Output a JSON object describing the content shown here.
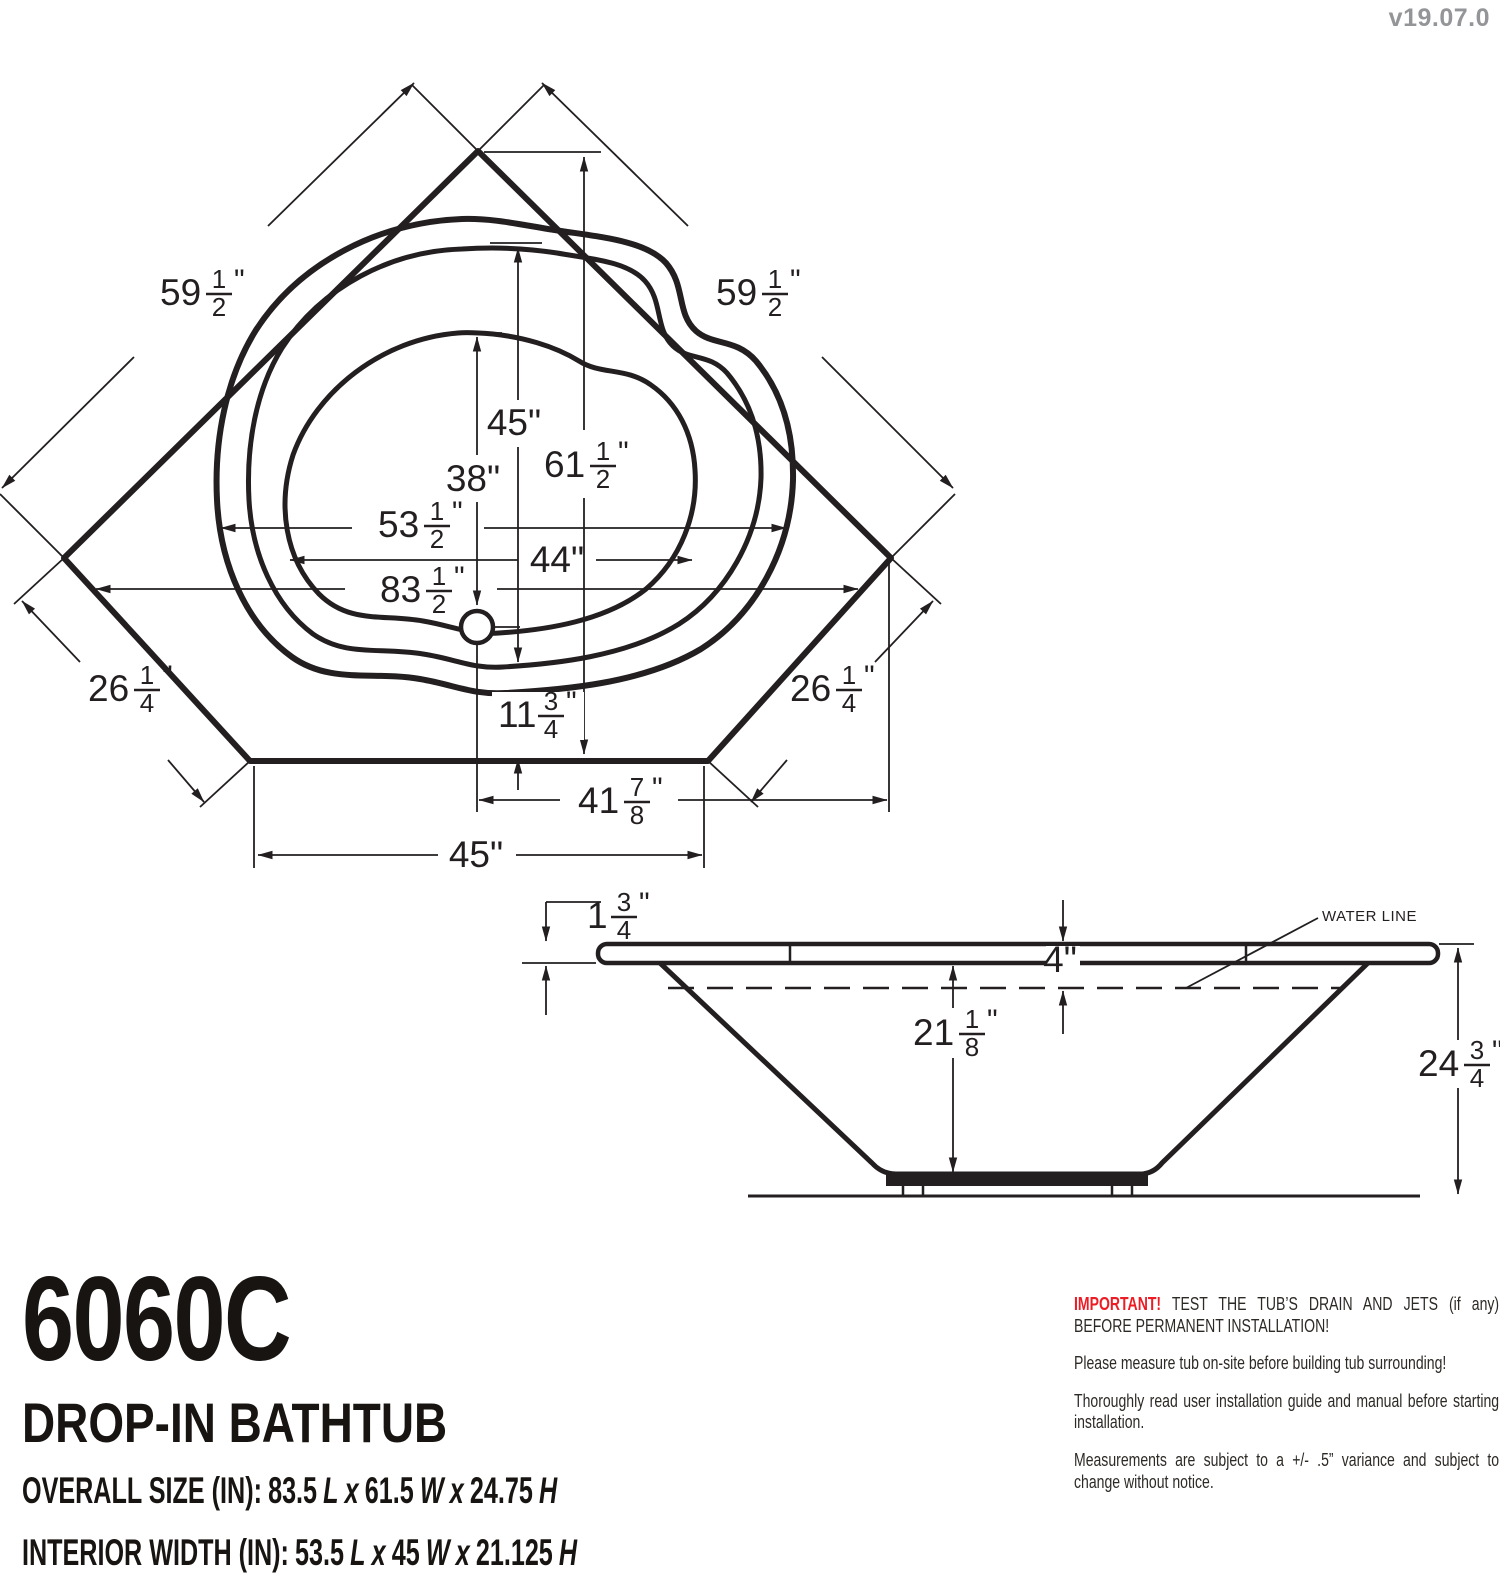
{
  "version": "v19.07.0",
  "marks": {
    "inch": "\""
  },
  "top_view": {
    "edge_left": {
      "whole": "59",
      "num": "1",
      "den": "2"
    },
    "edge_right": {
      "whole": "59",
      "num": "1",
      "den": "2"
    },
    "interior_length": {
      "whole": "45"
    },
    "basin_length": {
      "whole": "38"
    },
    "overall_width": {
      "whole": "61",
      "num": "1",
      "den": "2"
    },
    "interior_width": {
      "whole": "53",
      "num": "1",
      "den": "2"
    },
    "basin_width": {
      "whole": "44"
    },
    "overall_length": {
      "whole": "83",
      "num": "1",
      "den": "2"
    },
    "corner_left": {
      "whole": "26",
      "num": "1",
      "den": "4"
    },
    "corner_right": {
      "whole": "26",
      "num": "1",
      "den": "4"
    },
    "front_offset": {
      "whole": "11",
      "num": "3",
      "den": "4"
    },
    "drain_offset": {
      "whole": "41",
      "num": "7",
      "den": "8"
    },
    "front_width": {
      "whole": "45"
    }
  },
  "side_view": {
    "rim_thickness": {
      "whole": "1",
      "num": "3",
      "den": "4"
    },
    "waterline_depth": {
      "whole": "4"
    },
    "interior_depth": {
      "whole": "21",
      "num": "1",
      "den": "8"
    },
    "overall_height": {
      "whole": "24",
      "num": "3",
      "den": "4"
    },
    "water_line_label": "WATER LINE"
  },
  "title_block": {
    "model": "6060C",
    "product": "DROP-IN BATHTUB",
    "letters": {
      "l": "L",
      "w": "W",
      "h": "H",
      "x": "x"
    },
    "overall": {
      "label": "OVERALL SIZE (IN):",
      "length": "83.5",
      "width": "61.5",
      "height": "24.75"
    },
    "interior": {
      "label": "INTERIOR WIDTH (IN):",
      "length": "53.5",
      "width": "45",
      "height": "21.125"
    }
  },
  "notes": {
    "important_label": "IMPORTANT!",
    "important_text": "TEST THE TUB’S DRAIN AND JETS (if any) BEFORE PERMANENT INSTALLATION!",
    "note2": "Please measure tub on-site before building tub surrounding!",
    "note3": "Thoroughly read user installation guide and manual before starting installation.",
    "note4": "Measurements are subject to a +/- .5” variance and subject to change without notice."
  },
  "colors": {
    "ink": "#231f20",
    "red": "#ed1c24",
    "gray": "#939598"
  }
}
